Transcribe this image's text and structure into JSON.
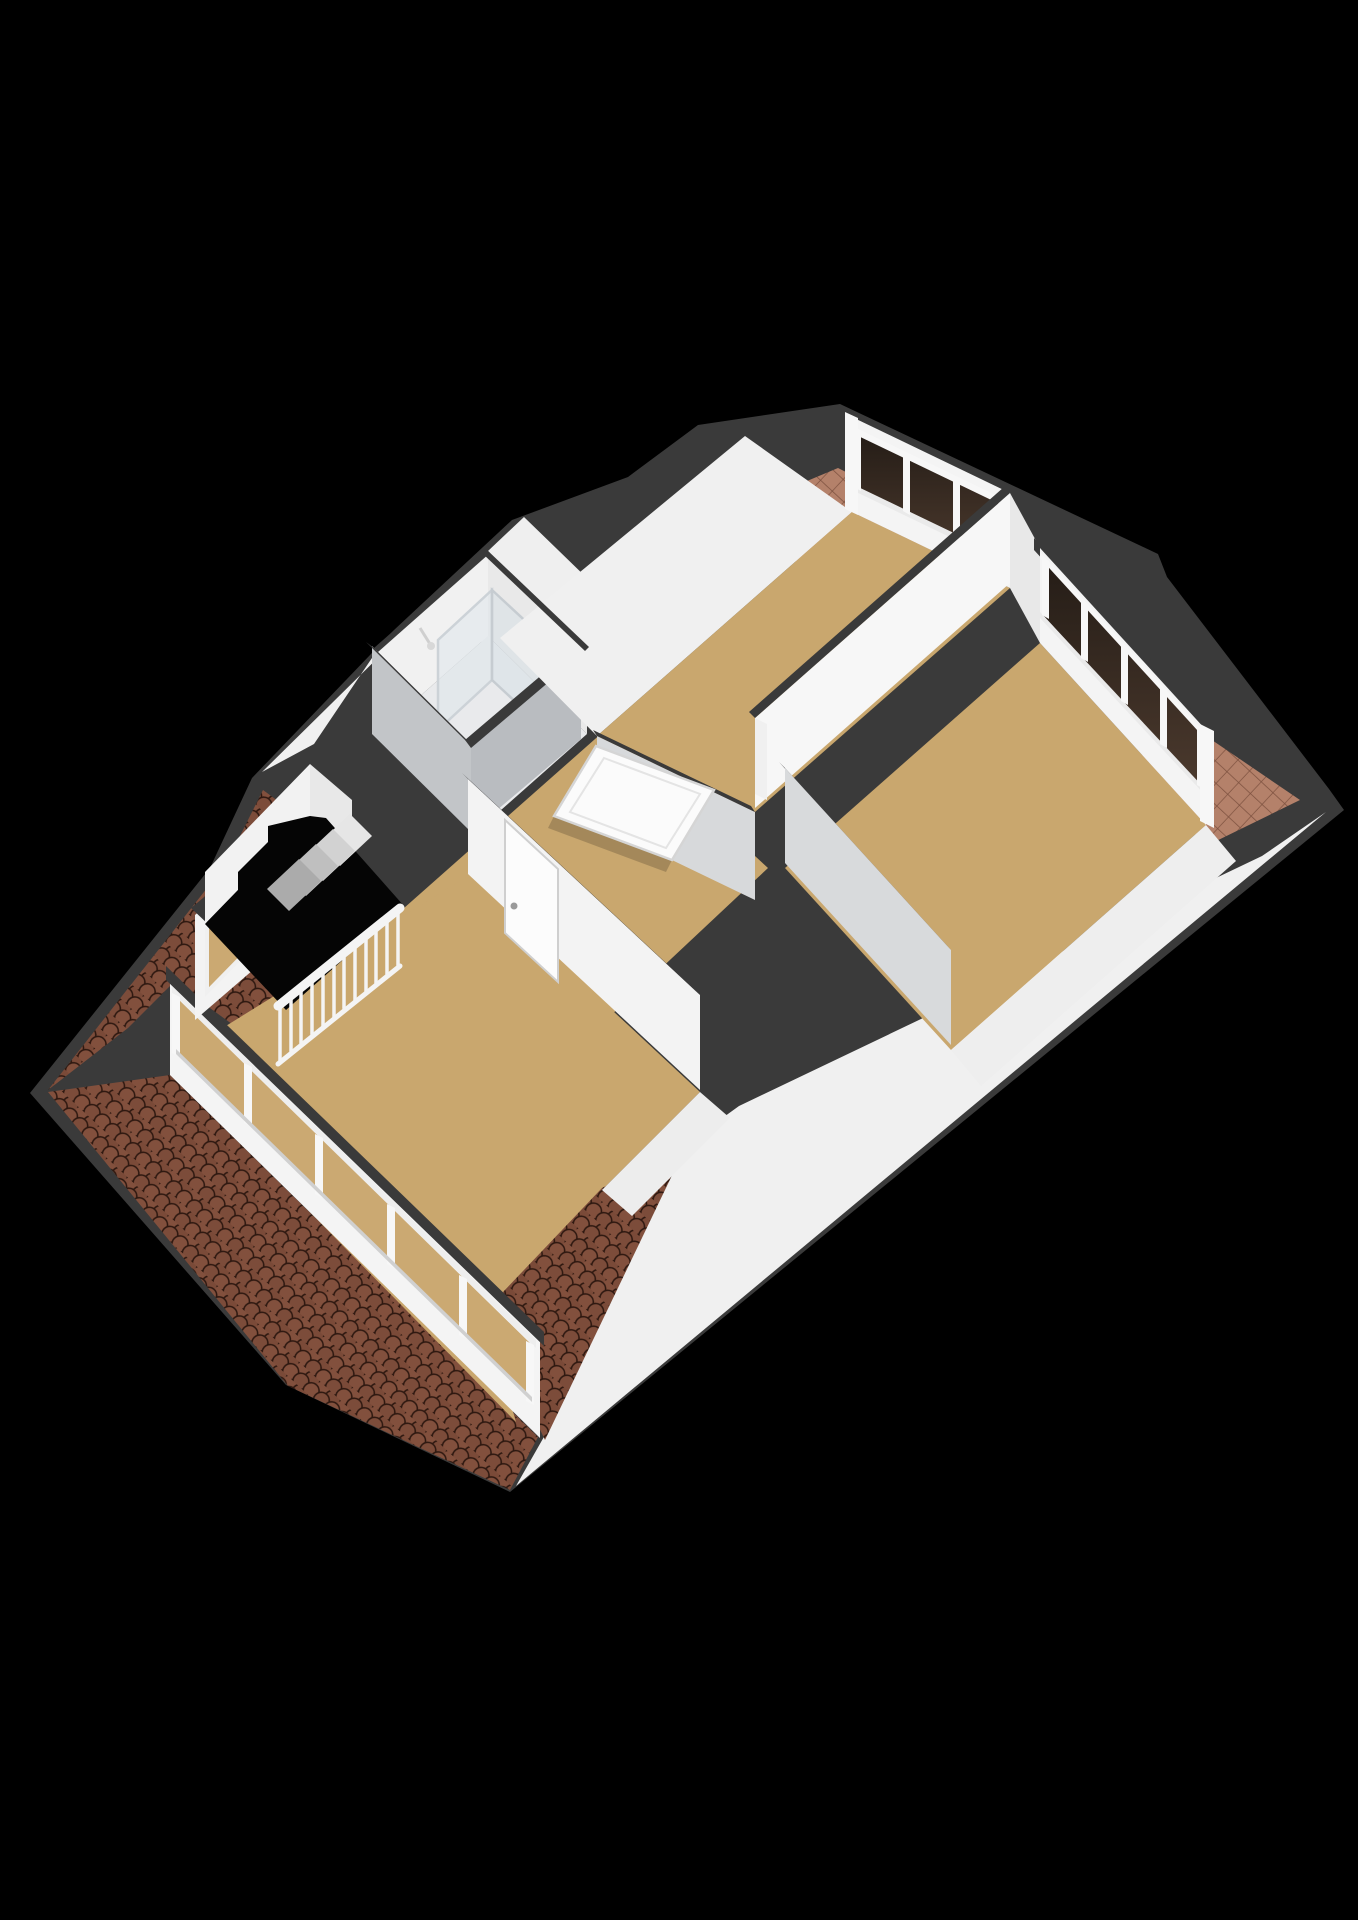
{
  "scene": {
    "type": "3d-floorplan-render",
    "view": "isometric-birds-eye",
    "floor_level": "attic-floor",
    "background": "#000000",
    "no_visible_text": true
  },
  "colors": {
    "background": "#000000",
    "roofband": "#3a3a3a",
    "wall": "#f4f4f4",
    "wallgray": "#c2c5c8",
    "slope": "#f0f0f0",
    "floor": "#c9a76e",
    "bathfloor": "#e9eaec",
    "rooftile": "#6b4130",
    "rooftilehi": "#82503d",
    "rooftileline": "#2e1810",
    "flattile": "#b4816a",
    "flattileline": "#7d513f",
    "frame": "#f7f7f7",
    "glassdark": "#3c2f26",
    "glasstan": "#cba972",
    "rail": "#f4f4f4",
    "wood": "#c59a63"
  },
  "features": {
    "rooms_visible": 5,
    "window_bands": [
      {
        "location": "upper-right-wall-left-room",
        "panes": 3
      },
      {
        "location": "upper-right-wall-large-room",
        "panes": 4
      },
      {
        "location": "lower-left-dormer",
        "panes": 5
      },
      {
        "location": "left-small-dormer",
        "panes": 1
      }
    ],
    "doors_visible": 2,
    "stairs": {
      "type": "open-stairwell",
      "balustrade": true,
      "balusters": 12
    },
    "bathroom": {
      "shower": true,
      "vanity": true
    },
    "roof": {
      "tiled_slopes": true,
      "flat_tile_strips": 2,
      "white_sloped_planes": true
    }
  }
}
